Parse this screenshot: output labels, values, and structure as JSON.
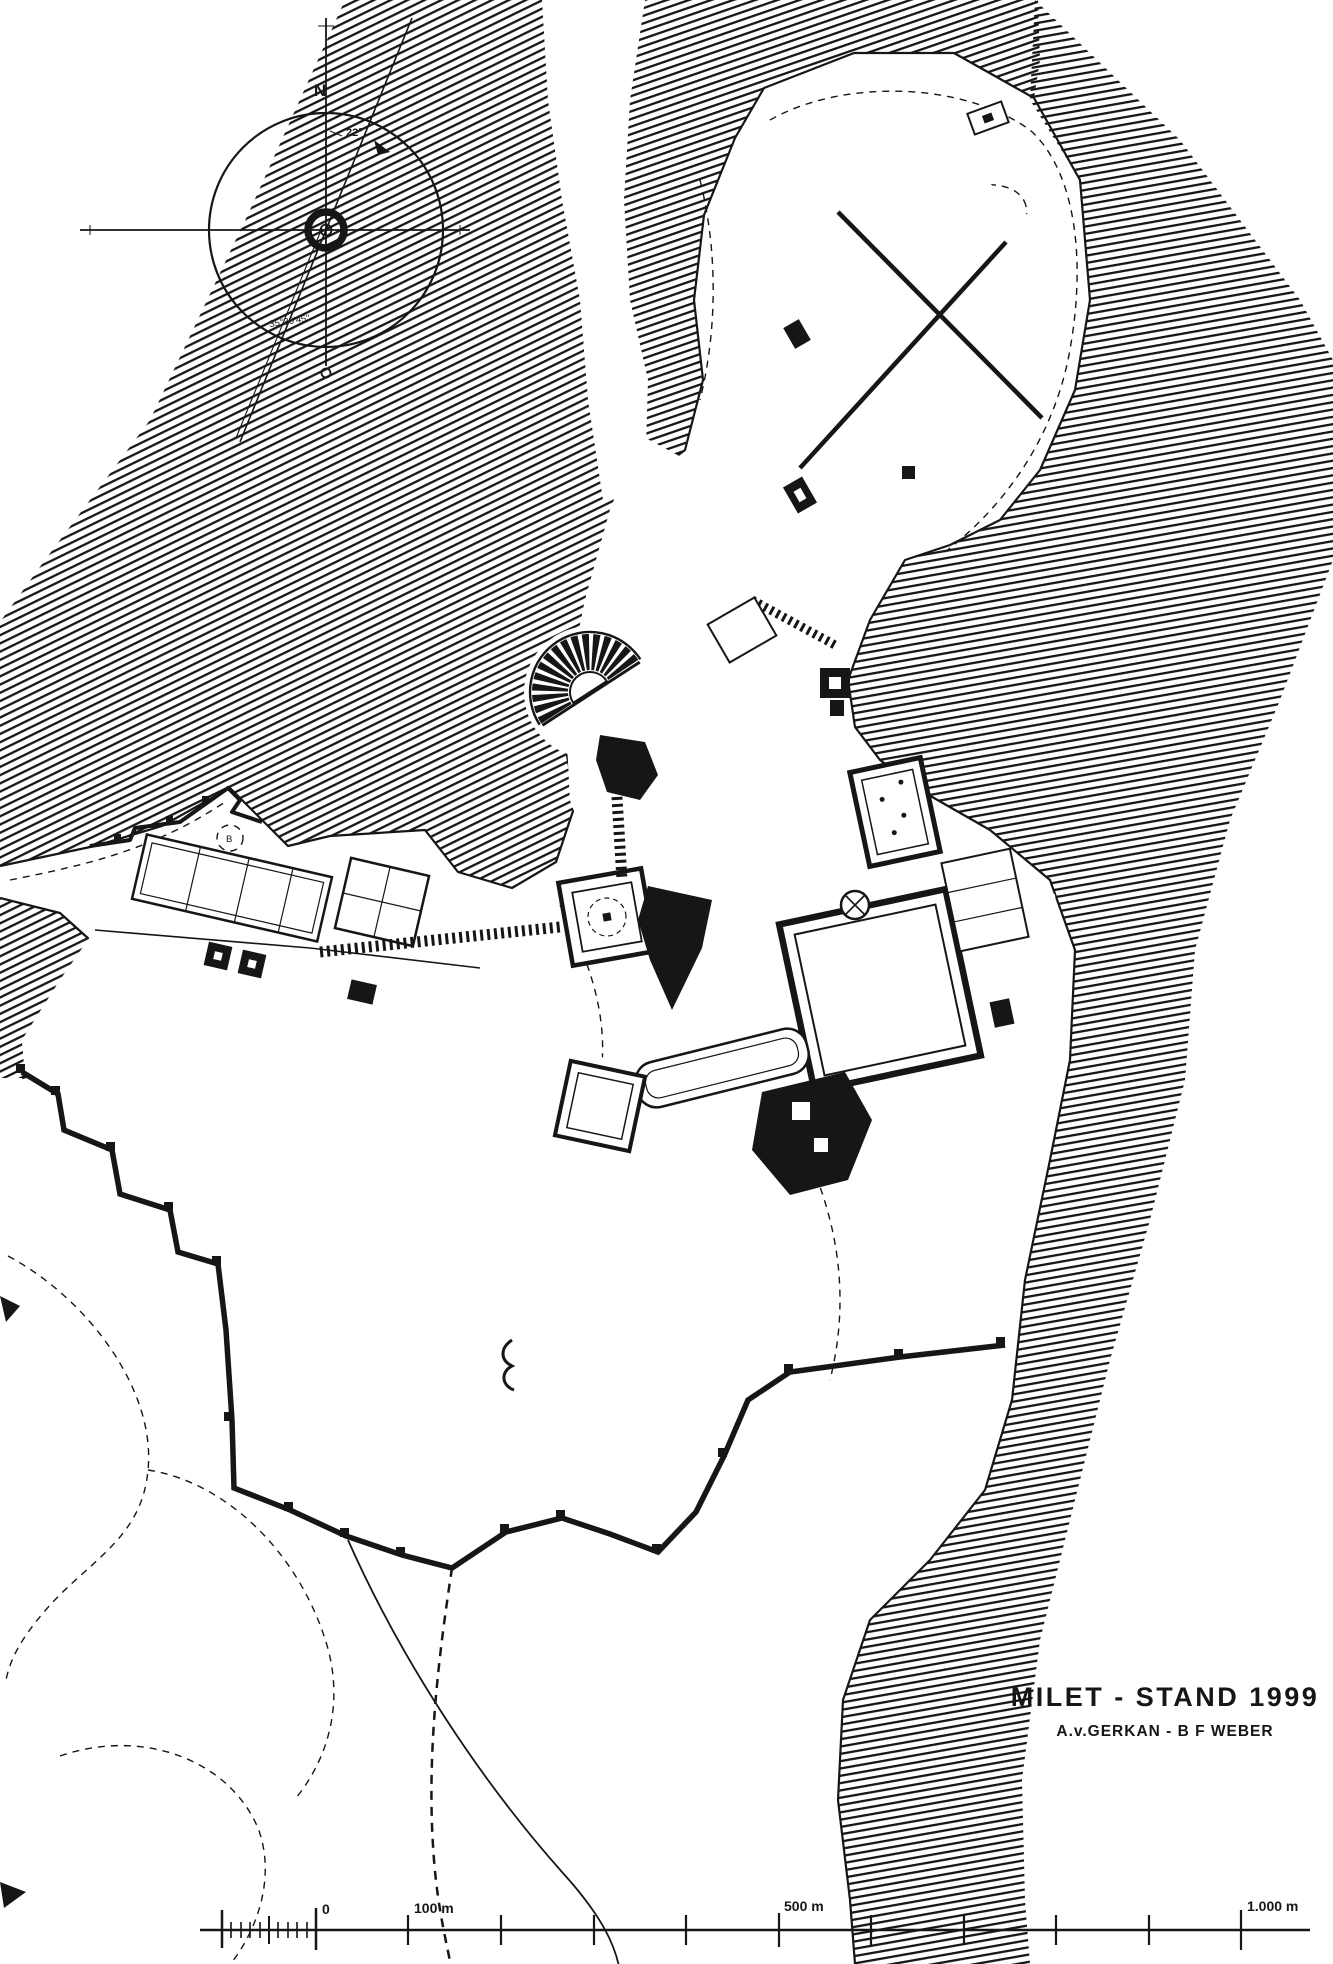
{
  "page": {
    "background": "#ffffff",
    "ink_color": "#161616"
  },
  "title": {
    "line1": "MILET - STAND 1999",
    "line2": "A.v.GERKAN - B F WEBER"
  },
  "compass": {
    "north_label": "N",
    "declination_label": "22°",
    "bearing_label": "35°30'45''"
  },
  "scale_bar": {
    "zero_label": "0",
    "label_100": "100 m",
    "label_500": "500 m",
    "label_1000": "1.000 m"
  },
  "annotations": {
    "label_b": "B"
  }
}
